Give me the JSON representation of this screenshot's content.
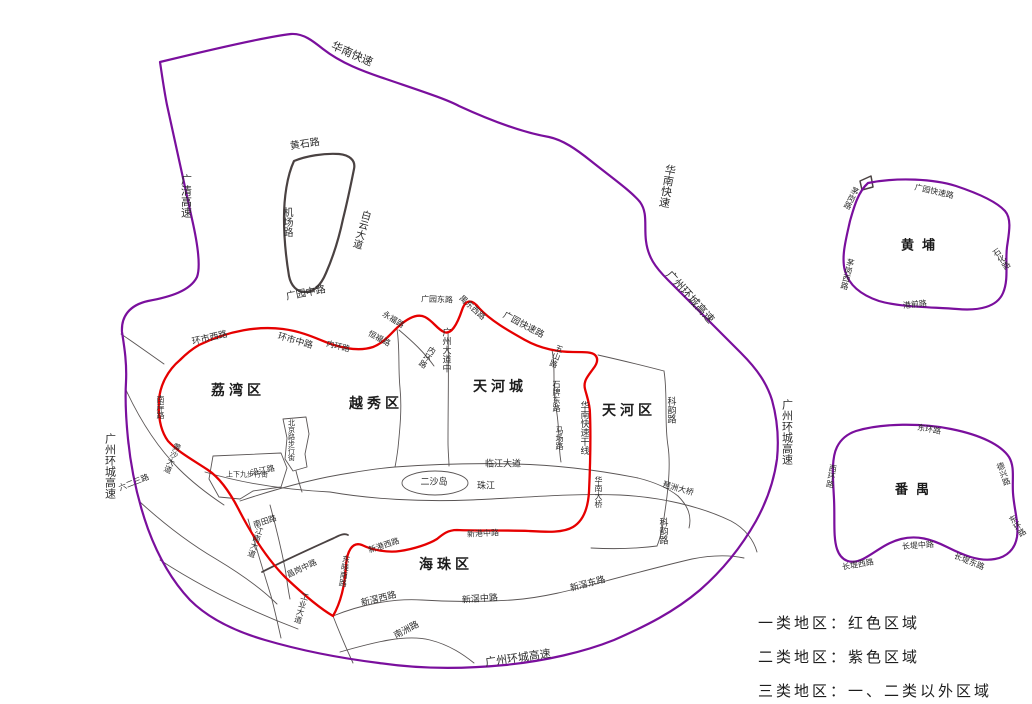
{
  "map": {
    "colors": {
      "class1_red": "#e60000",
      "class2_purple": "#7a0f9d",
      "road_dark": "#4a4242",
      "road_thin": "#5a5555",
      "text": "#2b2b2b",
      "background": "#ffffff"
    },
    "legend": {
      "items": [
        "一类地区：红色区域",
        "二类地区：紫色区域",
        "三类地区：一、二类以外区域"
      ]
    },
    "labels": [
      {
        "t": "华南快速",
        "x": 352,
        "y": 54,
        "r": 24,
        "s": 11
      },
      {
        "t": "广清高速",
        "x": 186,
        "y": 196,
        "v": true,
        "s": 11
      },
      {
        "t": "华南快速",
        "x": 667,
        "y": 186,
        "v": true,
        "r": 10,
        "s": 11
      },
      {
        "t": "广州环城高速",
        "x": 690,
        "y": 297,
        "r": 48,
        "s": 11
      },
      {
        "t": "广州环城高速",
        "x": 787,
        "y": 432,
        "v": true,
        "s": 11
      },
      {
        "t": "广州环城高速",
        "x": 110,
        "y": 466,
        "v": true,
        "s": 11
      },
      {
        "t": "广州环城高速",
        "x": 518,
        "y": 658,
        "r": -8,
        "s": 11
      },
      {
        "t": "黄石路",
        "x": 305,
        "y": 145,
        "r": -9,
        "s": 10
      },
      {
        "t": "机场路",
        "x": 286,
        "y": 222,
        "v": true,
        "s": 10
      },
      {
        "t": "白云大道",
        "x": 360,
        "y": 229,
        "v": true,
        "r": 16,
        "s": 10
      },
      {
        "t": "广园中路",
        "x": 306,
        "y": 294,
        "r": -11,
        "s": 10
      },
      {
        "t": "环市西路",
        "x": 210,
        "y": 339,
        "r": -13,
        "s": 9
      },
      {
        "t": "环市中路",
        "x": 295,
        "y": 342,
        "r": 16,
        "s": 9
      },
      {
        "t": "内环路",
        "x": 338,
        "y": 347,
        "r": 14,
        "s": 8
      },
      {
        "t": "恒福路",
        "x": 379,
        "y": 339,
        "r": 28,
        "s": 8
      },
      {
        "t": "永福路",
        "x": 393,
        "y": 320,
        "r": 32,
        "s": 8
      },
      {
        "t": "广园东路",
        "x": 437,
        "y": 300,
        "r": 2,
        "s": 8
      },
      {
        "t": "禺东西路",
        "x": 472,
        "y": 308,
        "r": 42,
        "s": 8
      },
      {
        "t": "广园快速路",
        "x": 523,
        "y": 326,
        "r": 28,
        "s": 9
      },
      {
        "t": "内环路",
        "x": 427,
        "y": 357,
        "v": true,
        "r": 32,
        "s": 8
      },
      {
        "t": "广州大道中",
        "x": 445,
        "y": 350,
        "v": true,
        "s": 9
      },
      {
        "t": "华南快速干线",
        "x": 583,
        "y": 428,
        "v": true,
        "s": 9
      },
      {
        "t": "华南大桥",
        "x": 598,
        "y": 492,
        "v": true,
        "s": 8
      },
      {
        "t": "五山路",
        "x": 556,
        "y": 356,
        "v": true,
        "r": 20,
        "s": 8
      },
      {
        "t": "石牌东路",
        "x": 556,
        "y": 396,
        "v": true,
        "s": 8
      },
      {
        "t": "马场路",
        "x": 559,
        "y": 438,
        "v": true,
        "s": 8
      },
      {
        "t": "科韵路",
        "x": 670,
        "y": 410,
        "v": true,
        "s": 9
      },
      {
        "t": "科韵路",
        "x": 662,
        "y": 531,
        "v": true,
        "s": 9
      },
      {
        "t": "琶洲大桥",
        "x": 678,
        "y": 489,
        "r": 16,
        "s": 8
      },
      {
        "t": "临江大道",
        "x": 503,
        "y": 465,
        "s": 9
      },
      {
        "t": "珠江",
        "x": 486,
        "y": 487,
        "s": 9
      },
      {
        "t": "二沙岛",
        "x": 434,
        "y": 483,
        "s": 9
      },
      {
        "t": "沿江路",
        "x": 263,
        "y": 471,
        "r": -12,
        "s": 8
      },
      {
        "t": "六二三路",
        "x": 134,
        "y": 483,
        "r": -22,
        "s": 8
      },
      {
        "t": "南岸路",
        "x": 160,
        "y": 407,
        "v": true,
        "s": 8
      },
      {
        "t": "黄沙大道",
        "x": 172,
        "y": 458,
        "v": true,
        "r": 22,
        "s": 8
      },
      {
        "t": "上下九步行街",
        "x": 247,
        "y": 475,
        "s": 7
      },
      {
        "t": "北京路步行街",
        "x": 291,
        "y": 440,
        "v": true,
        "s": 7
      },
      {
        "t": "新港中路",
        "x": 483,
        "y": 534,
        "r": -3,
        "s": 8
      },
      {
        "t": "新港西路",
        "x": 384,
        "y": 546,
        "r": -18,
        "s": 8
      },
      {
        "t": "东晓南路",
        "x": 344,
        "y": 571,
        "v": true,
        "r": 8,
        "s": 8
      },
      {
        "t": "昌岗中路",
        "x": 302,
        "y": 569,
        "r": -25,
        "s": 8
      },
      {
        "t": "江南大道",
        "x": 255,
        "y": 542,
        "v": true,
        "r": 18,
        "s": 8
      },
      {
        "t": "南田路",
        "x": 265,
        "y": 522,
        "r": -18,
        "s": 8
      },
      {
        "t": "工业大道",
        "x": 301,
        "y": 608,
        "v": true,
        "r": 16,
        "s": 8
      },
      {
        "t": "新滘西路",
        "x": 379,
        "y": 600,
        "r": -14,
        "s": 9
      },
      {
        "t": "新滘中路",
        "x": 480,
        "y": 600,
        "r": -4,
        "s": 9
      },
      {
        "t": "新滘东路",
        "x": 588,
        "y": 585,
        "r": -15,
        "s": 9
      },
      {
        "t": "南洲路",
        "x": 407,
        "y": 631,
        "r": -28,
        "s": 9
      },
      {
        "t": "荔湾区",
        "x": 238,
        "y": 391,
        "b": true,
        "s": 14,
        "ls": 4
      },
      {
        "t": "越秀区",
        "x": 376,
        "y": 404,
        "b": true,
        "s": 14,
        "ls": 4
      },
      {
        "t": "天河城",
        "x": 500,
        "y": 387,
        "b": true,
        "s": 14,
        "ls": 4
      },
      {
        "t": "天河区",
        "x": 629,
        "y": 411,
        "b": true,
        "s": 14,
        "ls": 4
      },
      {
        "t": "海珠区",
        "x": 446,
        "y": 565,
        "b": true,
        "s": 14,
        "ls": 4
      },
      {
        "t": "黄埔",
        "x": 922,
        "y": 246,
        "b": true,
        "s": 13,
        "ls": 8
      },
      {
        "t": "番禺",
        "x": 916,
        "y": 490,
        "b": true,
        "s": 13,
        "ls": 8
      },
      {
        "t": "广园快速路",
        "x": 934,
        "y": 192,
        "r": 13,
        "s": 8
      },
      {
        "t": "茅岗路",
        "x": 851,
        "y": 198,
        "v": true,
        "r": 26,
        "s": 8
      },
      {
        "t": "茅岗西路",
        "x": 847,
        "y": 274,
        "v": true,
        "r": 14,
        "s": 8
      },
      {
        "t": "港前路",
        "x": 915,
        "y": 305,
        "r": -6,
        "s": 8
      },
      {
        "t": "石化路",
        "x": 1001,
        "y": 259,
        "v": true,
        "r": -35,
        "s": 8
      },
      {
        "t": "东环路",
        "x": 929,
        "y": 430,
        "r": 10,
        "s": 8
      },
      {
        "t": "西环路",
        "x": 831,
        "y": 476,
        "v": true,
        "r": 10,
        "s": 8
      },
      {
        "t": "德兴路",
        "x": 1003,
        "y": 474,
        "v": true,
        "r": -20,
        "s": 8
      },
      {
        "t": "东环路",
        "x": 1017,
        "y": 526,
        "v": true,
        "r": -33,
        "s": 8
      },
      {
        "t": "长堤西路",
        "x": 858,
        "y": 565,
        "r": -10,
        "s": 8
      },
      {
        "t": "长堤中路",
        "x": 918,
        "y": 546,
        "r": -4,
        "s": 8
      },
      {
        "t": "长堤东路",
        "x": 969,
        "y": 562,
        "r": 22,
        "s": 8
      }
    ]
  }
}
